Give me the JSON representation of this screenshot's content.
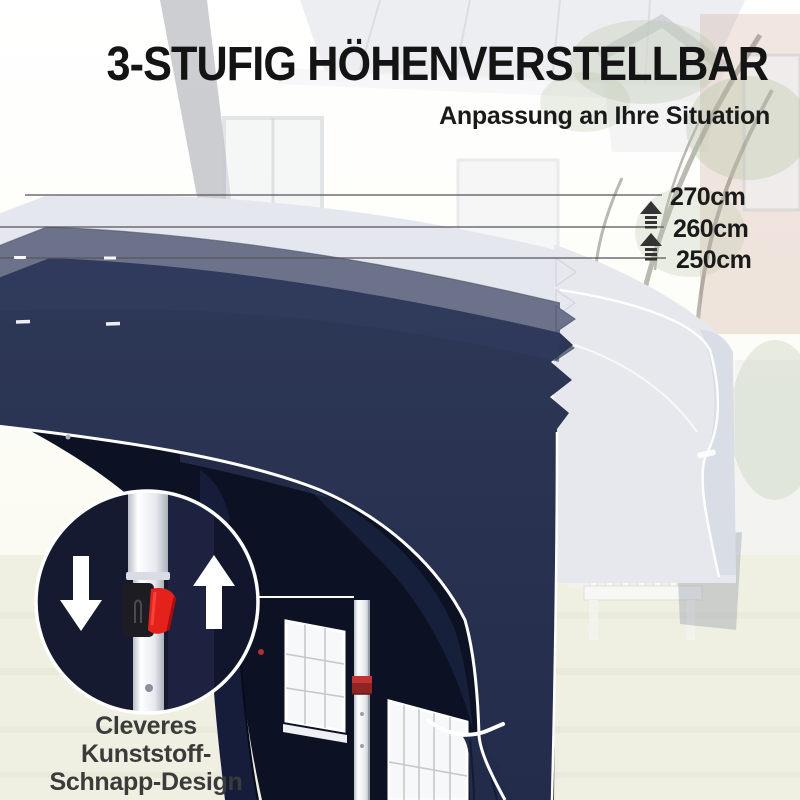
{
  "title": "3-STUFIG HÖHENVERSTELLBAR",
  "subtitle": "Anpassung an Ihre Situation",
  "measurements": {
    "items": [
      {
        "label": "270cm"
      },
      {
        "label": "260cm"
      },
      {
        "label": "250cm"
      }
    ],
    "indicator_icon": "up-arrow-icon"
  },
  "inset": {
    "caption_lines": [
      "Cleveres",
      "Kunststoff-",
      "Schnapp-Design"
    ],
    "left_icon": "down-arrow-icon",
    "right_icon": "up-arrow-icon",
    "mechanism": "red-snap-lever"
  },
  "colors": {
    "canopy_navy": "#2a3354",
    "canopy_navy_dark": "#232c4a",
    "canopy_mid_ghost": "#6b7289",
    "canopy_light_ghost": "#e5e7ee",
    "tent_interior": "#0c1124",
    "inset_background": "#151a31",
    "snap_lever_red": "#e5211b",
    "piping_white": "#ffffff",
    "measure_line": "#56575c",
    "heading_text": "#141414",
    "caption_text": "#3b3b3b",
    "grass": "#eff0e2"
  }
}
